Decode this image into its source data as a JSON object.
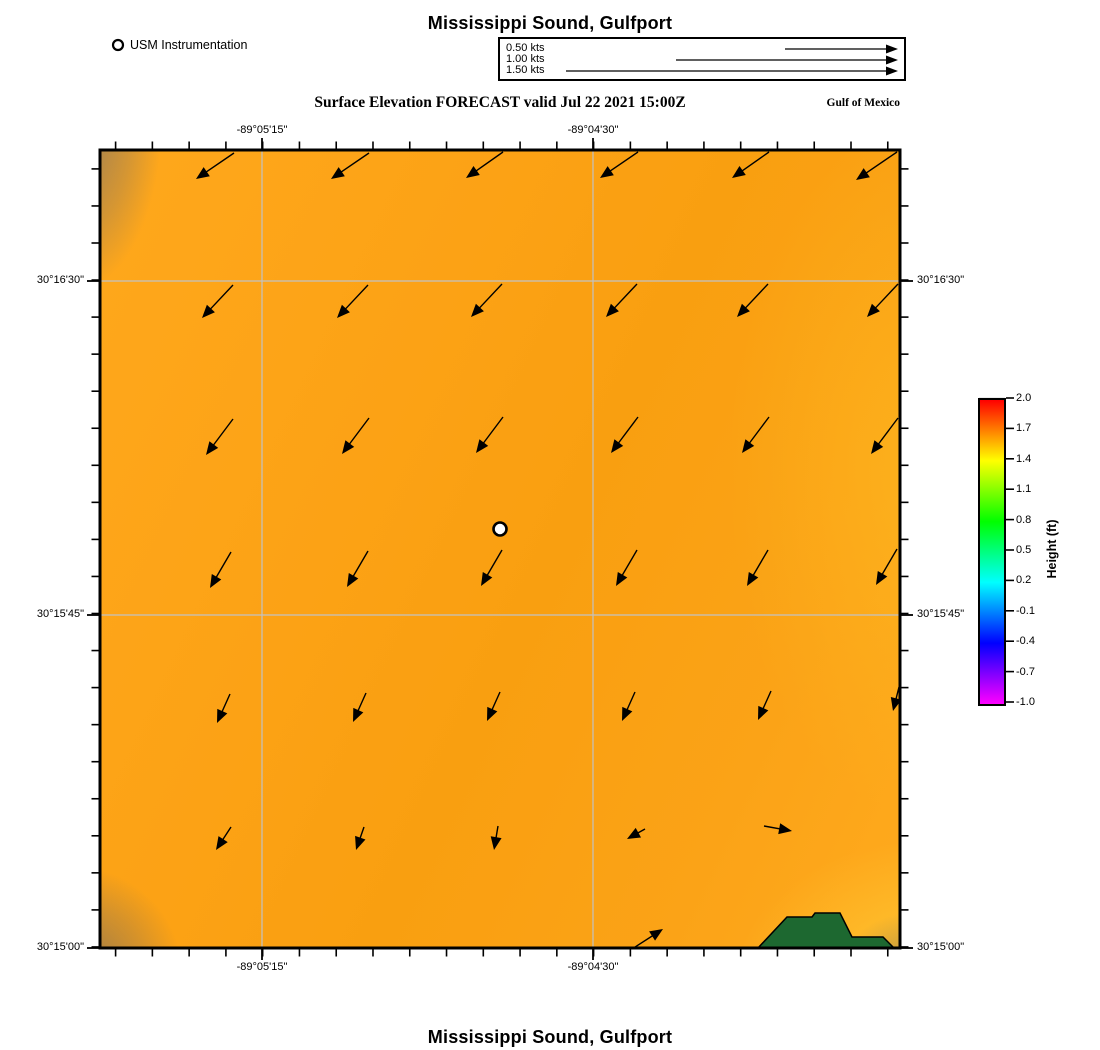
{
  "titles": {
    "top": "Mississippi Sound, Gulfport",
    "bottom": "Mississippi Sound, Gulfport",
    "subtitle": "Surface Elevation FORECAST valid Jul 22 2021 15:00Z",
    "region": "Gulf of Mexico"
  },
  "usm_legend": {
    "label": "USM Instrumentation"
  },
  "velocity_legend": {
    "items": [
      {
        "label": "0.50 kts",
        "length_px": 113
      },
      {
        "label": "1.00 kts",
        "length_px": 222
      },
      {
        "label": "1.50 kts",
        "length_px": 332
      }
    ]
  },
  "colorbar": {
    "label": "Height (ft)",
    "ticks": [
      "2.0",
      "1.7",
      "1.4",
      "1.1",
      "0.8",
      "0.5",
      "0.2",
      "-0.1",
      "-0.4",
      "-0.7",
      "-1.0"
    ],
    "value_max": 2.0,
    "value_min": -1.0,
    "gridline_color": "#d8d8d8"
  },
  "chart_data": {
    "type": "vector_field_map",
    "title": "Surface Elevation FORECAST valid Jul 22 2021 15:00Z",
    "field_shown": "surface elevation (ft), mostly ~1.6-1.7 ft (orange)",
    "map_rect": {
      "x": 100,
      "y": 150,
      "w": 800,
      "h": 798
    },
    "grid": {
      "vertical_x": [
        262,
        593
      ],
      "horizontal_y": [
        281,
        615
      ],
      "color": "#c2c2c2"
    },
    "x_axis": {
      "labels": [
        {
          "text": "-89°05'15\"",
          "x": 262
        },
        {
          "text": "-89°04'30\"",
          "x": 593
        }
      ],
      "tick_start": 115.6,
      "tick_step": 36.77,
      "tick_count": 22
    },
    "y_axis": {
      "labels": [
        {
          "text": "30°16'30\"",
          "y": 281
        },
        {
          "text": "30°15'45\"",
          "y": 615
        },
        {
          "text": "30°15'00\"",
          "y": 948
        }
      ],
      "tick_start": 168.9,
      "tick_step": 37.05,
      "tick_count": 22
    },
    "station": {
      "x": 500,
      "y": 529,
      "name": "USM Instrumentation"
    },
    "land_polygon": {
      "color": "#1d6830",
      "points": [
        [
          758,
          948
        ],
        [
          787,
          917
        ],
        [
          812,
          917
        ],
        [
          815,
          913
        ],
        [
          840,
          913
        ],
        [
          852,
          937
        ],
        [
          883,
          937
        ],
        [
          894,
          948
        ]
      ]
    },
    "arrows": [
      [
        234,
        153,
        196,
        179
      ],
      [
        369,
        153,
        331,
        179
      ],
      [
        503,
        152,
        466,
        178
      ],
      [
        638,
        152,
        600,
        178
      ],
      [
        769,
        152,
        732,
        178
      ],
      [
        897,
        152,
        856,
        180
      ],
      [
        233,
        285,
        202,
        318
      ],
      [
        368,
        285,
        337,
        318
      ],
      [
        502,
        284,
        471,
        317
      ],
      [
        637,
        284,
        606,
        317
      ],
      [
        768,
        284,
        737,
        317
      ],
      [
        898,
        284,
        867,
        317
      ],
      [
        233,
        419,
        206,
        455
      ],
      [
        369,
        418,
        342,
        454
      ],
      [
        503,
        417,
        476,
        453
      ],
      [
        638,
        417,
        611,
        453
      ],
      [
        769,
        417,
        742,
        453
      ],
      [
        898,
        418,
        871,
        454
      ],
      [
        231,
        552,
        210,
        588
      ],
      [
        368,
        551,
        347,
        587
      ],
      [
        502,
        550,
        481,
        586
      ],
      [
        637,
        550,
        616,
        586
      ],
      [
        768,
        550,
        747,
        586
      ],
      [
        897,
        549,
        876,
        585
      ],
      [
        230,
        694,
        217,
        723
      ],
      [
        366,
        693,
        353,
        722
      ],
      [
        500,
        692,
        487,
        721
      ],
      [
        635,
        692,
        622,
        721
      ],
      [
        771,
        691,
        758,
        720
      ],
      [
        899,
        687,
        893,
        711
      ],
      [
        231,
        827,
        216,
        850
      ],
      [
        364,
        827,
        356,
        850
      ],
      [
        498,
        826,
        494,
        850
      ],
      [
        645,
        829,
        627,
        839
      ],
      [
        764,
        826,
        792,
        831
      ],
      [
        632,
        949,
        663,
        929
      ]
    ]
  }
}
